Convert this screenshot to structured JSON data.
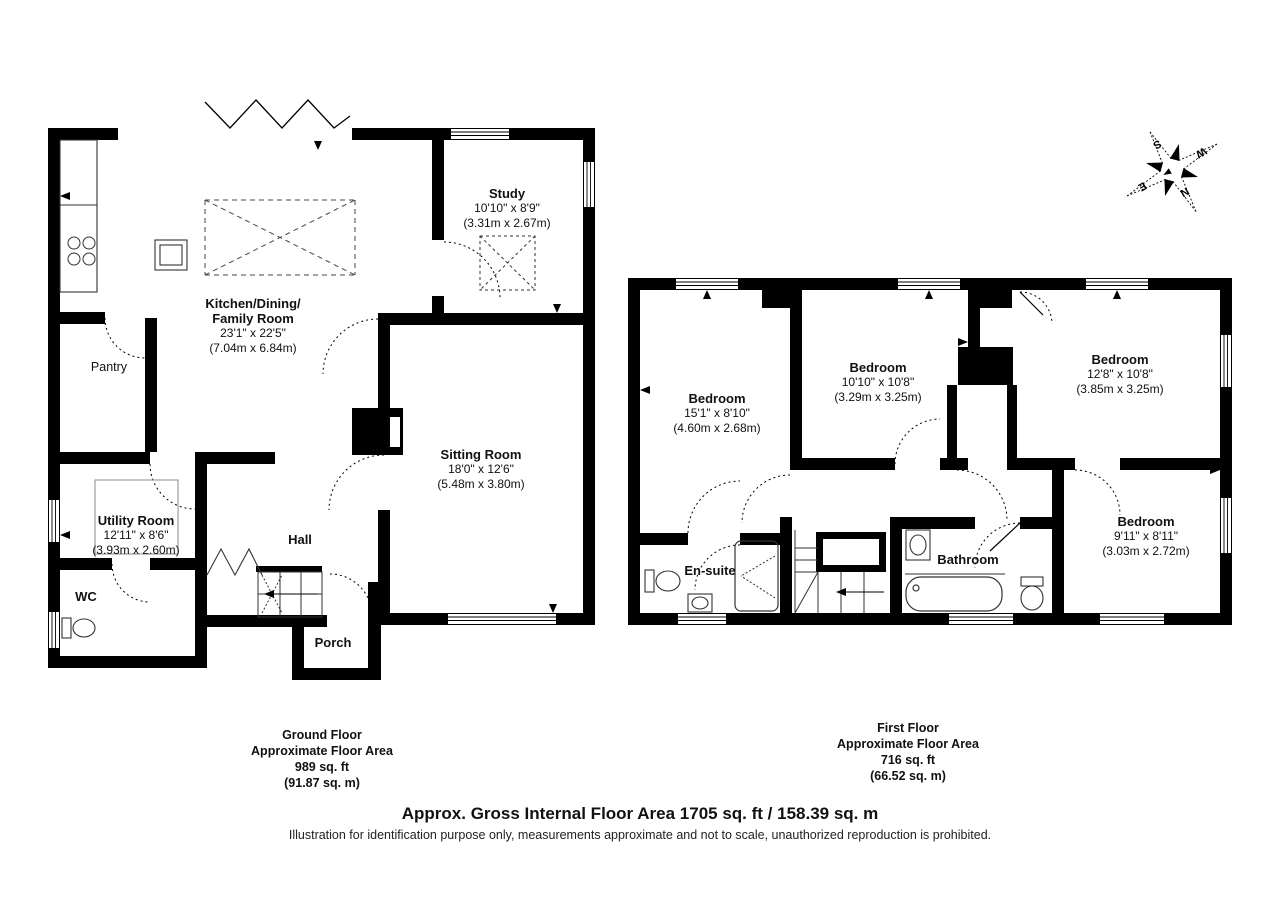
{
  "compass": {
    "n": "N",
    "e": "E",
    "s": "S",
    "w": "W"
  },
  "ground_floor": {
    "rooms": {
      "kitchen": {
        "name": "Kitchen/Dining/",
        "name2": "Family Room",
        "dims_ft": "23'1\" x 22'5\"",
        "dims_m": "(7.04m x 6.84m)"
      },
      "pantry": {
        "name": "Pantry"
      },
      "study": {
        "name": "Study",
        "dims_ft": "10'10\" x 8'9\"",
        "dims_m": "(3.31m x 2.67m)"
      },
      "sitting_room": {
        "name": "Sitting Room",
        "dims_ft": "18'0\" x 12'6\"",
        "dims_m": "(5.48m x 3.80m)"
      },
      "utility_room": {
        "name": "Utility Room",
        "dims_ft": "12'11\" x 8'6\"",
        "dims_m": "(3.93m x 2.60m)"
      },
      "hall": {
        "name": "Hall"
      },
      "wc": {
        "name": "WC"
      },
      "porch": {
        "name": "Porch"
      }
    },
    "caption": {
      "line1": "Ground Floor",
      "line2": "Approximate Floor Area",
      "line3": "989 sq. ft",
      "line4": "(91.87 sq. m)"
    }
  },
  "first_floor": {
    "rooms": {
      "bedroom_1": {
        "name": "Bedroom",
        "dims_ft": "15'1\" x 8'10\"",
        "dims_m": "(4.60m x 2.68m)"
      },
      "bedroom_2": {
        "name": "Bedroom",
        "dims_ft": "10'10\" x 10'8\"",
        "dims_m": "(3.29m x 3.25m)"
      },
      "bedroom_3": {
        "name": "Bedroom",
        "dims_ft": "12'8\" x 10'8\"",
        "dims_m": "(3.85m x 3.25m)"
      },
      "bedroom_4": {
        "name": "Bedroom",
        "dims_ft": "9'11\" x 8'11\"",
        "dims_m": "(3.03m x 2.72m)"
      },
      "ensuite": {
        "name": "En-suite"
      },
      "bathroom": {
        "name": "Bathroom"
      }
    },
    "caption": {
      "line1": "First Floor",
      "line2": "Approximate Floor Area",
      "line3": "716 sq. ft",
      "line4": "(66.52 sq. m)"
    }
  },
  "footer": {
    "title": "Approx. Gross Internal Floor Area 1705 sq. ft / 158.39 sq. m",
    "disclaimer": "Illustration for identification purpose only, measurements approximate and not to scale, unauthorized reproduction is prohibited."
  },
  "colors": {
    "wall": "#000000",
    "background": "#ffffff"
  }
}
